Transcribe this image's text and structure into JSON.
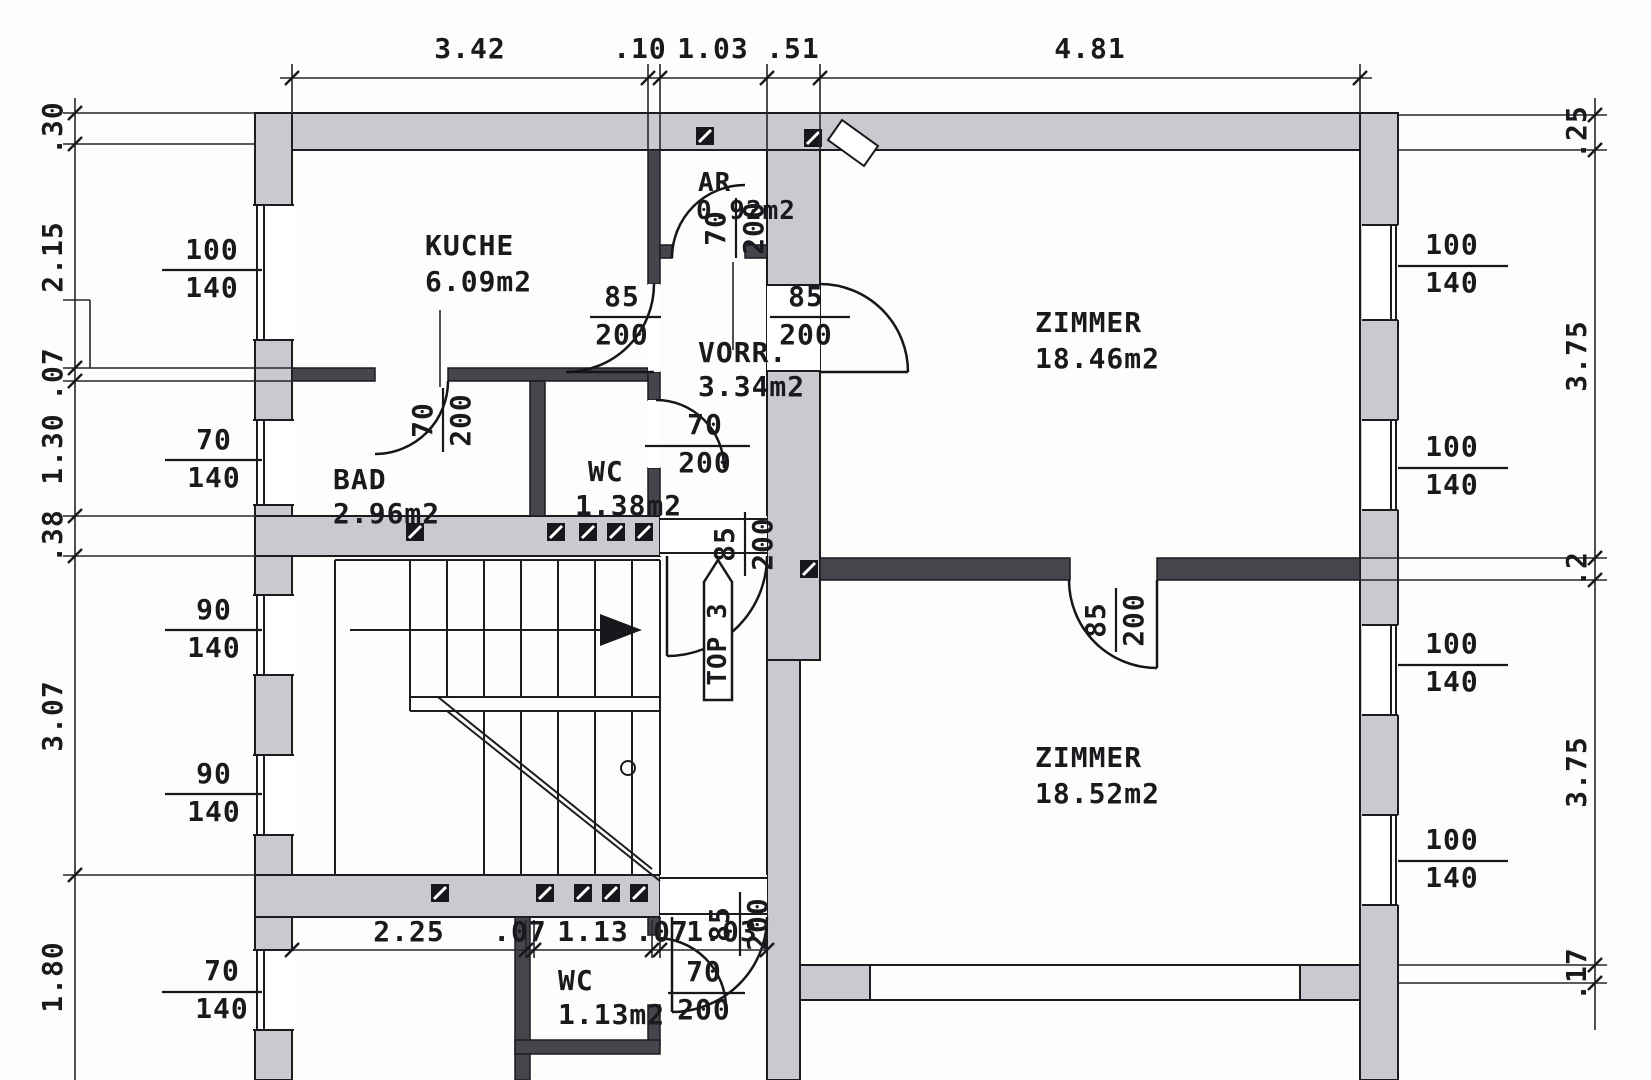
{
  "drawing": {
    "unit_arrow_label": "TOP 3",
    "rooms": {
      "kueche": {
        "name": "KUCHE",
        "area": "6.09m2"
      },
      "ar": {
        "name": "AR",
        "area": "0.92m2"
      },
      "vorraum": {
        "name": "VORR.",
        "area": "3.34m2"
      },
      "zimmer1": {
        "name": "ZIMMER",
        "area": "18.46m2"
      },
      "bad": {
        "name": "BAD",
        "area": "2.96m2"
      },
      "wc1": {
        "name": "WC",
        "area": "1.38m2"
      },
      "zimmer2": {
        "name": "ZIMMER",
        "area": "18.52m2"
      },
      "wc2": {
        "name": "WC",
        "area": "1.13m2"
      }
    },
    "dims": {
      "top": [
        "3.42",
        ".10",
        "1.03",
        ".51",
        "4.81"
      ],
      "left": [
        ".30",
        "2.15",
        ".07",
        "1.30",
        ".38",
        "3.07",
        "1.80"
      ],
      "right": [
        ".25",
        "3.75",
        ".2",
        "3.75",
        ".17"
      ],
      "bottom": [
        "2.25",
        ".07",
        "1.13",
        ".07",
        "1.03"
      ]
    },
    "windows": {
      "left": [
        {
          "w": "100",
          "h": "140"
        },
        {
          "w": "70",
          "h": "140"
        },
        {
          "w": "90",
          "h": "140"
        },
        {
          "w": "90",
          "h": "140"
        },
        {
          "w": "70",
          "h": "140"
        }
      ],
      "right": [
        {
          "w": "100",
          "h": "140"
        },
        {
          "w": "100",
          "h": "140"
        },
        {
          "w": "100",
          "h": "140"
        },
        {
          "w": "100",
          "h": "140"
        }
      ]
    },
    "doors": {
      "ar": {
        "w": "70",
        "h": "200"
      },
      "kueche": {
        "w": "85",
        "h": "200"
      },
      "zimmer1": {
        "w": "85",
        "h": "200"
      },
      "wc1": {
        "w": "70",
        "h": "200"
      },
      "bad": {
        "w": "70",
        "h": "200"
      },
      "entry": {
        "w": "85",
        "h": "200"
      },
      "zimmer2": {
        "w": "85",
        "h": "200"
      },
      "corridor": {
        "w": "85",
        "h": "200"
      },
      "wc2": {
        "w": "70",
        "h": "200"
      }
    }
  }
}
